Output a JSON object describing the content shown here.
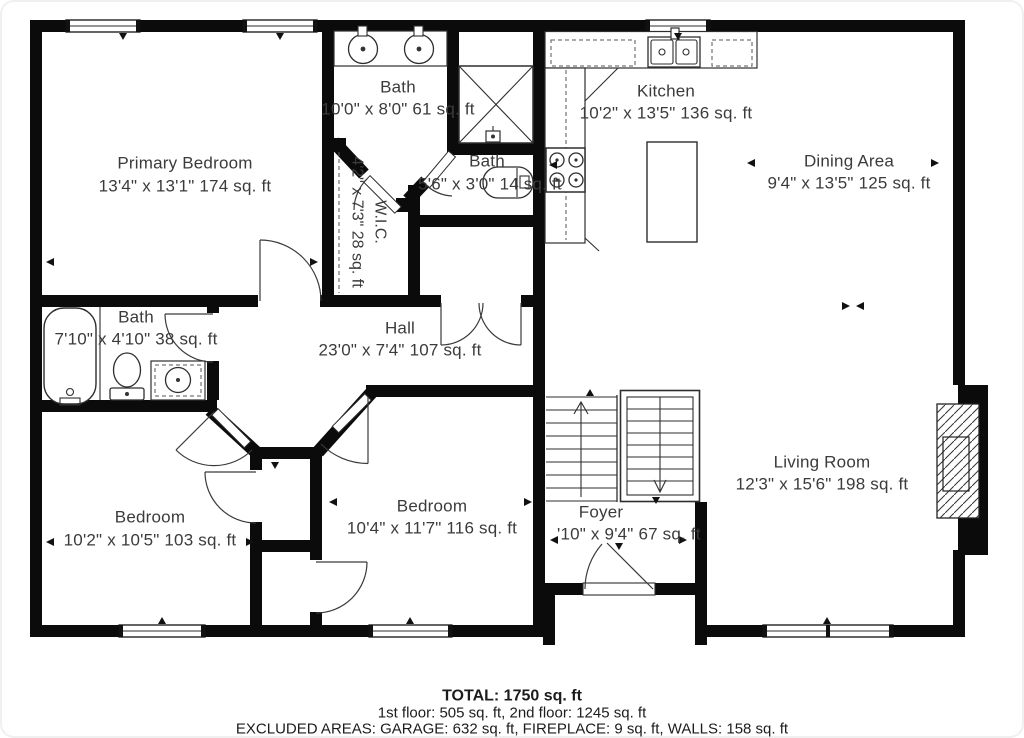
{
  "plan": {
    "rooms": {
      "primary": {
        "name": "Primary Bedroom",
        "dims": "13'4\" x 13'1\" 174 sq. ft"
      },
      "bath_main": {
        "name": "Bath",
        "dims": "10'0\" x 8'0\" 61 sq. ft"
      },
      "bath_half": {
        "name": "Bath",
        "dims": "5'6\" x 3'0\" 14 sq. ft"
      },
      "wic": {
        "name": "W.I.C.",
        "dims": "4'2\" x 7'3\" 28 sq. ft"
      },
      "kitchen": {
        "name": "Kitchen",
        "dims": "10'2\" x 13'5\" 136 sq. ft"
      },
      "dining": {
        "name": "Dining Area",
        "dims": "9'4\" x 13'5\" 125 sq. ft"
      },
      "bath_hall": {
        "name": "Bath",
        "dims": "7'10\" x 4'10\" 38 sq. ft"
      },
      "hall": {
        "name": "Hall",
        "dims": "23'0\" x 7'4\" 107 sq. ft"
      },
      "bedroom_left": {
        "name": "Bedroom",
        "dims": "10'2\" x 10'5\" 103 sq. ft"
      },
      "bedroom_mid": {
        "name": "Bedroom",
        "dims": "10'4\" x 11'7\" 116 sq. ft"
      },
      "foyer": {
        "name": "Foyer",
        "dims": "'10\" x 9'4\" 67 sq. ft"
      },
      "living": {
        "name": "Living Room",
        "dims": "12'3\" x 15'6\" 198 sq. ft"
      }
    },
    "summary": {
      "total": "TOTAL: 1750 sq. ft",
      "floors": "1st floor: 505 sq. ft, 2nd floor: 1245 sq. ft",
      "excluded": "EXCLUDED AREAS: GARAGE: 632 sq. ft, FIREPLACE: 9 sq. ft, WALLS: 158 sq. ft"
    },
    "fixtures": {
      "bathtub": "rounded-rect",
      "toilet": "ellipse-tank",
      "shower": "x-box",
      "double-vanity": "two-circles",
      "kitchen-sink": "double-basin",
      "stove": "four-burners",
      "island": "rect",
      "staircase": "treads-arrows",
      "fireplace": "hatched-box",
      "window": "double-line",
      "door": "quarter-arc"
    },
    "colors": {
      "wall": "#0b0b0b",
      "line": "#2e2e2e",
      "text": "#3b3b3b",
      "background": "#ffffff"
    }
  }
}
